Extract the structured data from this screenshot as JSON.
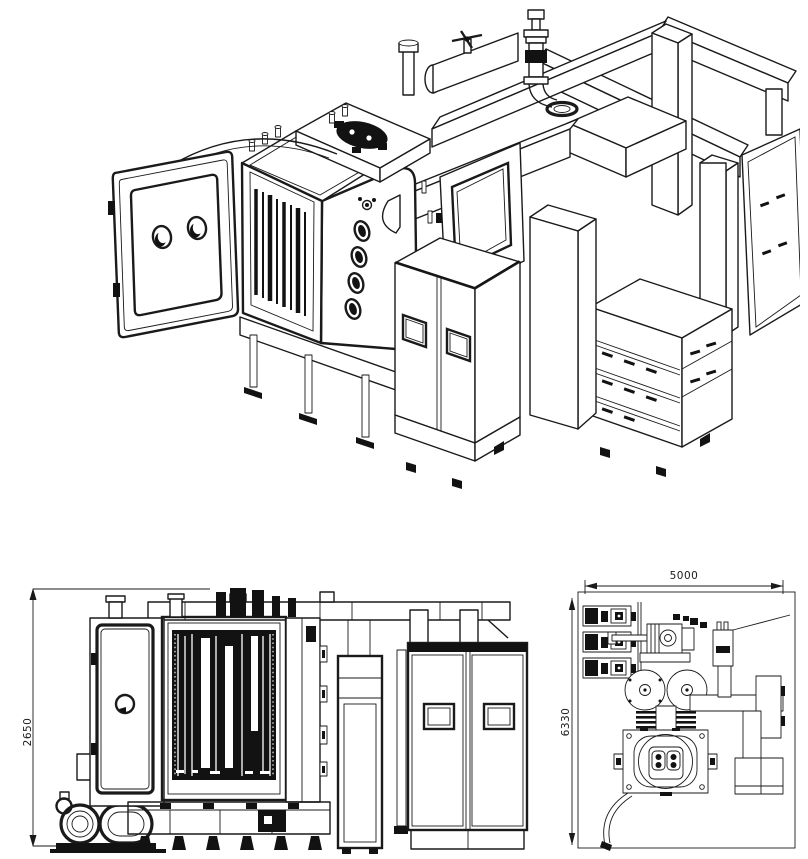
{
  "sheet": {
    "background_color": "#ffffff",
    "line_color": "#1a1a1a",
    "content": "vacuum-coating-machine-technical-drawing"
  },
  "views": {
    "front_elevation": {
      "height_mm": "2650"
    },
    "top_plan": {
      "width_mm": "5000",
      "depth_mm": "6330"
    }
  }
}
